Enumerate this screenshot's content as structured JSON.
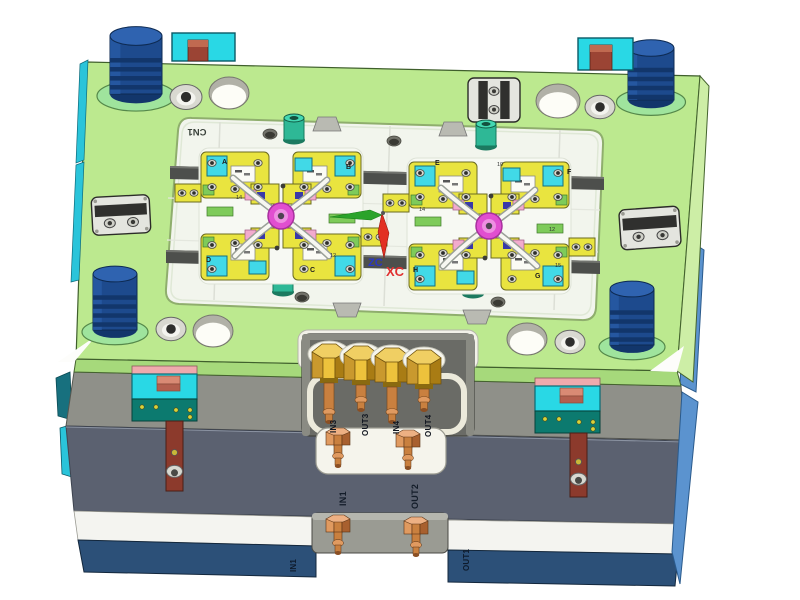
{
  "scene": {
    "type": "3d-cad-view",
    "description": "Isometric CAD view of a plastic injection mold assembly: green cavity plate with two four-cavity clusters, guide pins, clamps, and labeled cooling water ports",
    "wcs": {
      "x_label": "XC",
      "z_label": "ZC"
    },
    "labels": {
      "corner_code": "CN1"
    },
    "ports": {
      "front_row": [
        {
          "label": "IN3"
        },
        {
          "label": "OUT3"
        },
        {
          "label": "IN4"
        },
        {
          "label": "OUT4"
        }
      ],
      "middle_row": [
        {
          "label": "IN1"
        },
        {
          "label": "OUT2"
        }
      ],
      "bottom_row": [
        {
          "label": "IN1"
        },
        {
          "label": "OUT1"
        }
      ]
    },
    "cavity_letters": [
      {
        "t": "A",
        "x": 222,
        "y": 164
      },
      {
        "t": "B",
        "x": 346,
        "y": 169
      },
      {
        "t": "D",
        "x": 206,
        "y": 262
      },
      {
        "t": "C",
        "x": 310,
        "y": 272
      },
      {
        "t": "E",
        "x": 435,
        "y": 165
      },
      {
        "t": "F",
        "x": 567,
        "y": 174
      },
      {
        "t": "H",
        "x": 413,
        "y": 272
      },
      {
        "t": "G",
        "x": 535,
        "y": 278
      }
    ],
    "cavity_numbers": [
      {
        "t": "10",
        "x": 497,
        "y": 166
      },
      {
        "t": "14",
        "x": 419,
        "y": 211
      },
      {
        "t": "12",
        "x": 549,
        "y": 231
      },
      {
        "t": "15",
        "x": 555,
        "y": 267
      },
      {
        "t": "14",
        "x": 236,
        "y": 199
      },
      {
        "t": "12",
        "x": 330,
        "y": 257
      }
    ],
    "colors": {
      "bg": "#ffffff",
      "plate_top": "#bce98f",
      "plate_front": "#a6d97b",
      "plate_side": "#cdeea6",
      "plate_outline": "#44632e",
      "pocket_floor": "#f2f5ed",
      "pocket_rim": "#8fae6d",
      "rail": "#4d4f4c",
      "gray_band": "#8f9089",
      "gray_band_dark": "#6a6b66",
      "slate": "#5b6170",
      "white_band": "#f4f4f0",
      "blue_band": "#2c5078",
      "side_blue": "#5b93cf",
      "side_cyan": "#2ac4da",
      "side_teal": "#17707e",
      "pin_body": "#1d4a8d",
      "pin_dark": "#12366b",
      "pin_top": "#2f63b0",
      "pin_ring": "#9fe49d",
      "clamp_cyan": "#29d8e5",
      "clamp_pink": "#efaaad",
      "clamp_teal": "#0c7a6f",
      "clamp_brown": "#9b4434",
      "clamp_brown_light": "#c06a50",
      "bar_brown": "#8c3a2c",
      "latch_light": "#e4e5df",
      "latch_dark": "#30302e",
      "screw_ring": "#d9d9d1",
      "screw_dark": "#2e2e2c",
      "hole_wall": "#b1b1a7",
      "hole_floor": "#fdfdf7",
      "brass_light": "#f0cf63",
      "brass_mid": "#edc23c",
      "brass_dark": "#a97c14",
      "brass_side": "#c9992e",
      "copper": "#c9803f",
      "copper_light": "#e09a60",
      "copper_dark": "#a8602f",
      "cav_yellow": "#e9e43f",
      "cav_cyan": "#41d9e7",
      "cav_white": "#fbfbf5",
      "cav_green": "#7ecb5a",
      "cav_pink": "#f2abcd",
      "cav_navy": "#3939a8",
      "magenta": "#e14fd0",
      "magenta_mid": "#ee8fe2",
      "runner_gray": "#9aa098",
      "runner_white": "#f7f7f1",
      "pillar_teal": "#2eb896",
      "pillar_top": "#43d8b2",
      "pillar_dark": "#13503e",
      "wcs_green": "#2aa32a",
      "wcs_red": "#e23022",
      "label_dark": "#10151f",
      "label_blueband": "#0e1b2c",
      "label_slate": "#141d2a",
      "xc_red": "#e03030",
      "zc_blue": "#2936c8",
      "cn1": "#39413a"
    }
  }
}
